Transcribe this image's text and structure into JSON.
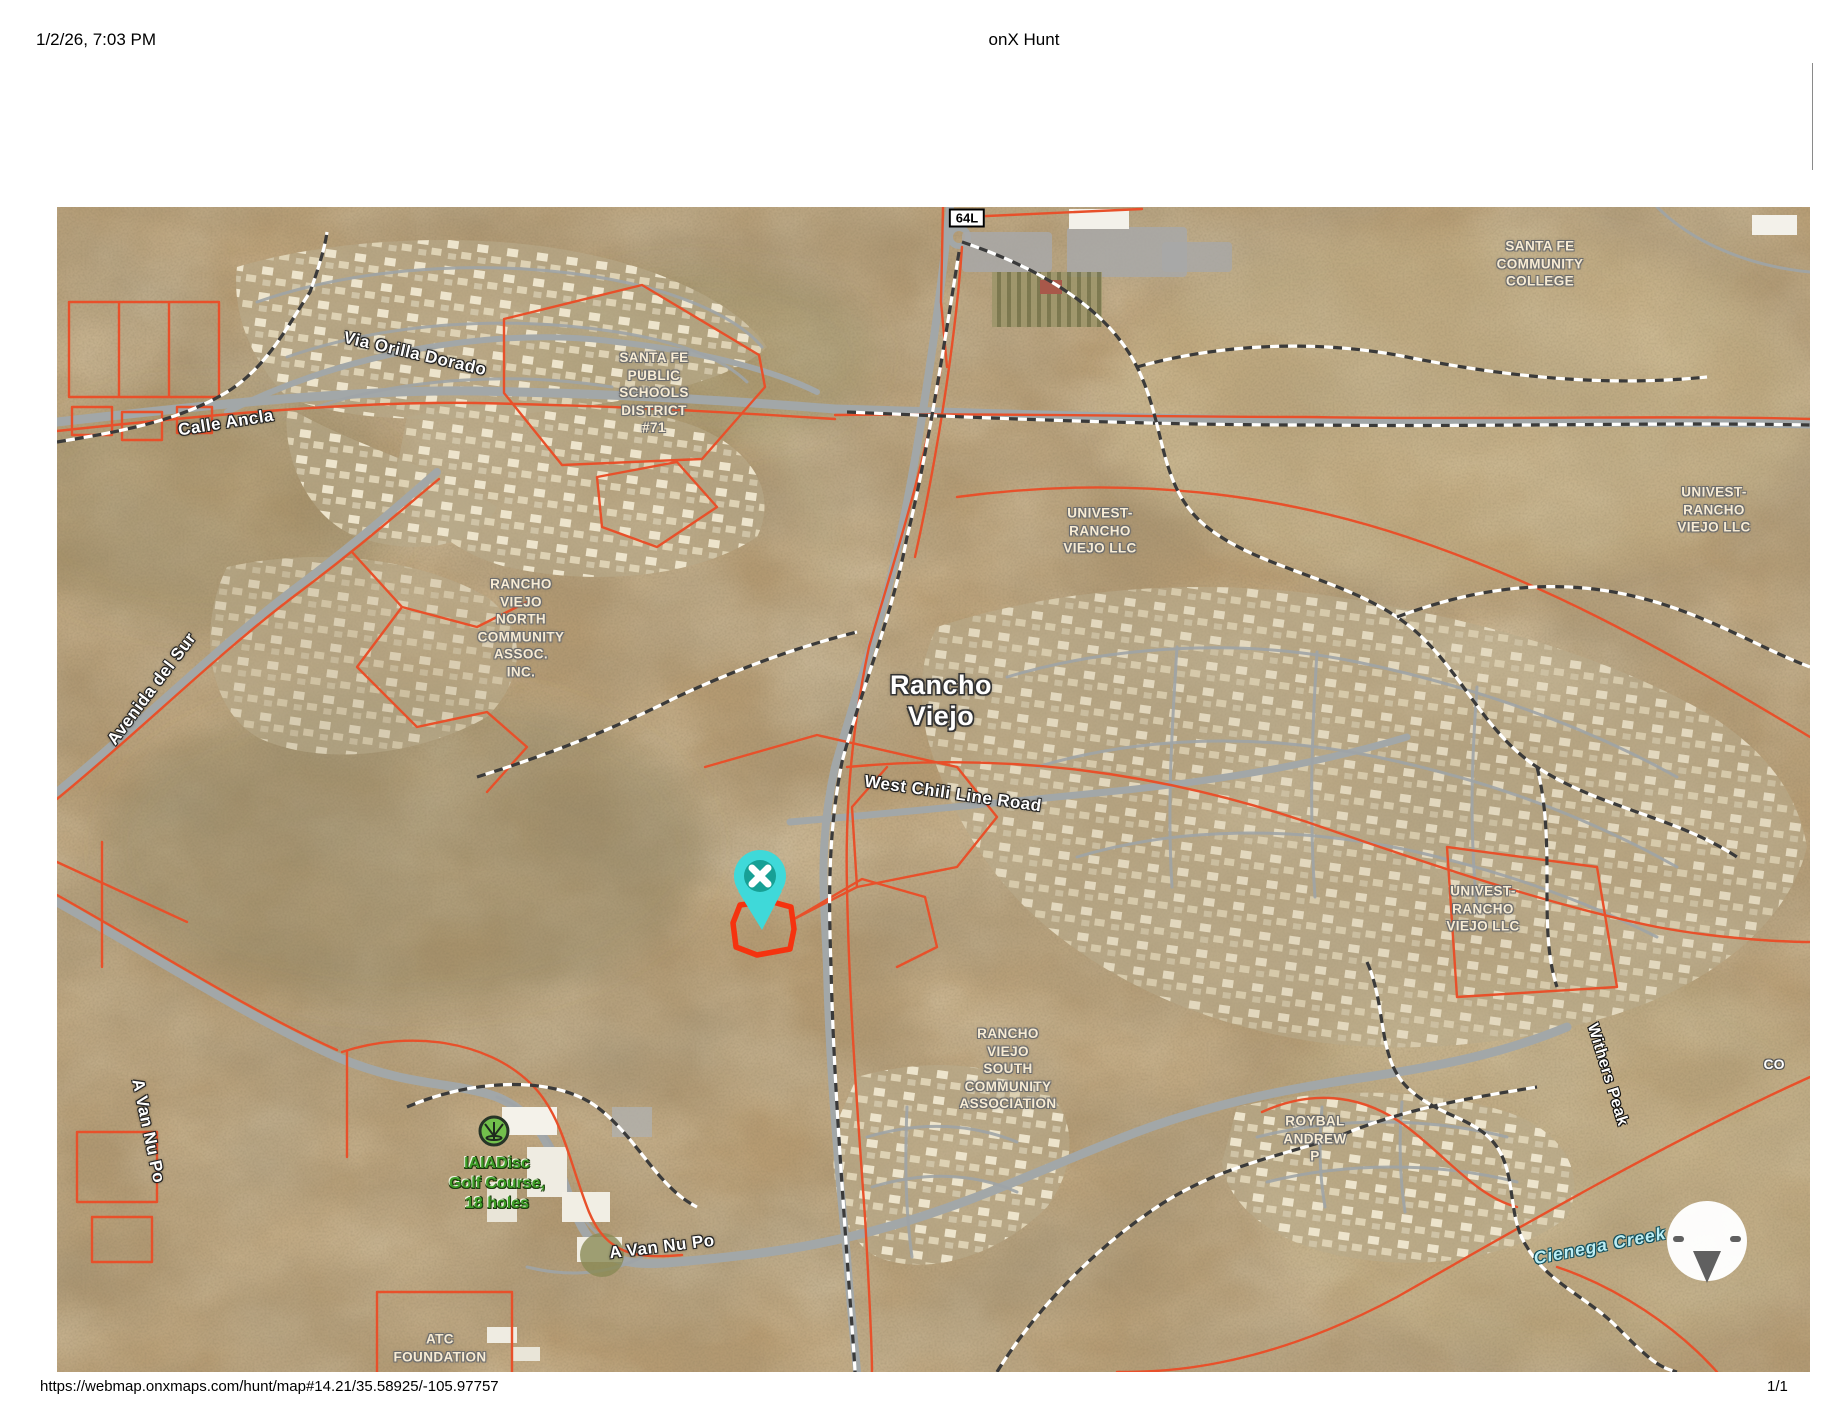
{
  "header": {
    "timestamp": "1/2/26, 7:03 PM",
    "title": "onX Hunt"
  },
  "footer": {
    "url": "https://webmap.onxmaps.com/hunt/map#14.21/35.58925/-105.97757",
    "page_number": "1/1"
  },
  "map": {
    "route_badge": "64L",
    "place_labels": {
      "rancho_viejo": {
        "lines": [
          "Rancho",
          "Viejo"
        ]
      },
      "withers_peak": "Withers Peak",
      "cienega_creek": "Cienega Creek",
      "co_truncated": "CO"
    },
    "parcel_labels": {
      "sf_community_college": {
        "lines": [
          "SANTA FE",
          "COMMUNITY",
          "COLLEGE"
        ]
      },
      "sf_public_schools": {
        "lines": [
          "SANTA FE",
          "PUBLIC",
          "SCHOOLS",
          "DISTRICT",
          "#71"
        ]
      },
      "rv_north": {
        "lines": [
          "RANCHO",
          "VIEJO",
          "NORTH",
          "COMMUNITY",
          "ASSOC.",
          "INC."
        ]
      },
      "univest_center": {
        "lines": [
          "UNIVEST-",
          "RANCHO",
          "VIEJO LLC"
        ]
      },
      "univest_ne": {
        "lines": [
          "UNIVEST-",
          "RANCHO",
          "VIEJO LLC"
        ]
      },
      "univest_east": {
        "lines": [
          "UNIVEST-",
          "RANCHO",
          "VIEJO LLC"
        ]
      },
      "rv_south": {
        "lines": [
          "RANCHO",
          "VIEJO",
          "SOUTH",
          "COMMUNITY",
          "ASSOCIATION"
        ]
      },
      "roybal": {
        "lines": [
          "ROYBAL",
          "ANDREW",
          "P"
        ]
      },
      "atc": {
        "lines": [
          "ATC",
          "FOUNDATION"
        ]
      }
    },
    "road_labels": {
      "via_orilla": "Via Orilla Dorado",
      "calle_ancla": "Calle Ancla",
      "avenida_del_sur": "Avenida del Sur",
      "west_chili": "West Chili Line Road",
      "a_van_nu_po_left": "A Van Nu Po",
      "a_van_nu_po_bottom": "A Van Nu Po"
    },
    "poi": {
      "golf_course": {
        "lines": [
          "IAIADisc",
          "Golf Course,",
          "18 holes"
        ]
      }
    },
    "colors": {
      "parcel_line": "#e8502a",
      "selected_parcel": "#f5330f",
      "marker_teal": "#3fd9d9",
      "marker_teal_dark": "#17a095",
      "creek_label": "#bceef5",
      "golf_label": "#3e9e27"
    }
  }
}
